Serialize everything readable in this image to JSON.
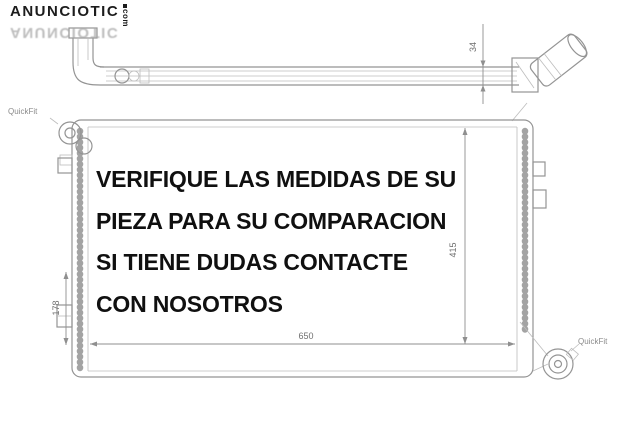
{
  "watermark": {
    "brand": "ANUNCIOTIC",
    "tld": "com"
  },
  "overlay": {
    "lines": [
      "VERIFIQUE LAS MEDIDAS DE SU",
      "PIEZA PARA SU COMPARACION",
      "SI TIENE DUDAS CONTACTE",
      "CON NOSOTROS"
    ]
  },
  "diagram": {
    "type": "radiator technical drawing",
    "dimensions": {
      "depth": "34",
      "width": "650",
      "height": "415",
      "left_offset": "178"
    },
    "labels": {
      "quickfit_top_left": "QuickFit",
      "quickfit_bottom_right": "QuickFit"
    },
    "colors": {
      "background": "#ffffff",
      "drawing_line": "#949494",
      "dimension_text": "#6f6f6f",
      "overlay_text": "#101010",
      "watermark": "#1c1c1c",
      "watermark_reflection": "#a8a8a8"
    }
  }
}
